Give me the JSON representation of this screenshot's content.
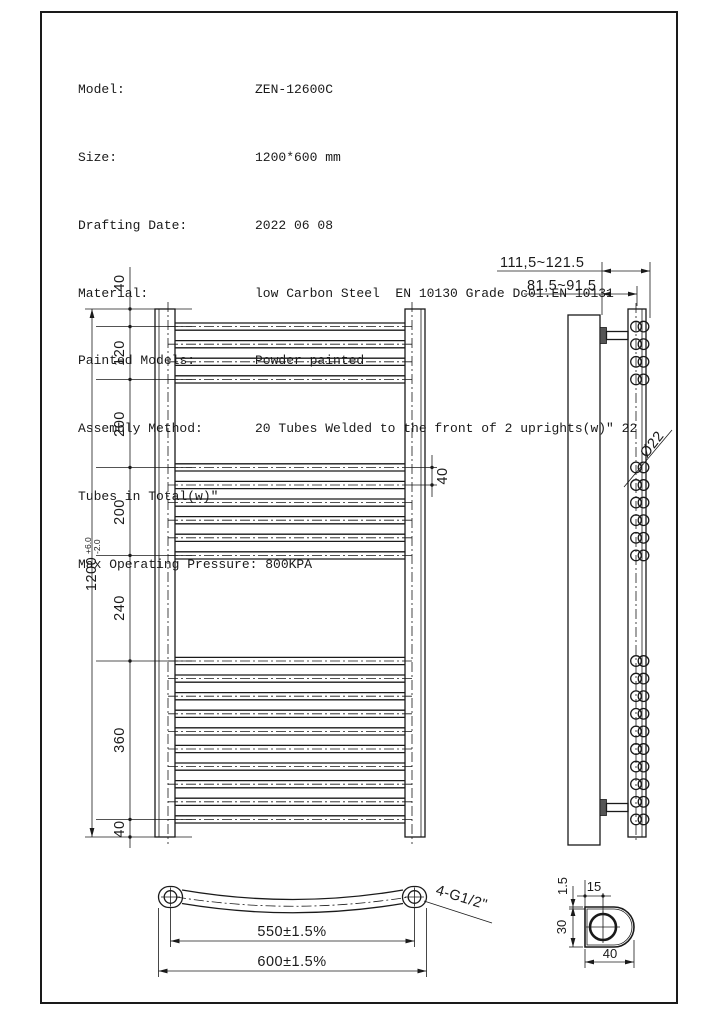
{
  "spec": {
    "rows": [
      {
        "label": "Model:",
        "value": "ZEN-12600C"
      },
      {
        "label": "Size:",
        "value": "1200*600 mm"
      },
      {
        "label": "Drafting Date:",
        "value": "2022 06 08"
      },
      {
        "label": "Material:",
        "value": "low Carbon Steel  EN 10130 Grade Dc01.EN 10131"
      },
      {
        "label": "Painted Models:",
        "value": "Powder painted"
      },
      {
        "label": "Assembly Method:",
        "value": "20 Tubes Welded to the front of 2 uprights(w)\" 22"
      }
    ],
    "assembly_continuation": "Tubes in Total(w)\"",
    "pressure_line": "Max Operating Pressure: 800KPA"
  },
  "front_view": {
    "overall": {
      "value": "1200",
      "tol_plus": "+6.0",
      "tol_minus": "-2.0"
    },
    "chain_labels": [
      "40",
      "120",
      "200",
      "200",
      "240",
      "360",
      "40"
    ],
    "pitch_label": "40",
    "pitch_mm": 40,
    "height_mm": 1200,
    "tube_groups": [
      {
        "start_mm": 40,
        "count": 4
      },
      {
        "start_mm": 360,
        "count": 6
      },
      {
        "start_mm": 800,
        "count": 10
      }
    ]
  },
  "side_view": {
    "dim_wall_to_front": "111,5~121.5",
    "dim_wall_to_upright": "81,5~91.5",
    "tube_diameter": "Ø22"
  },
  "bottom_view": {
    "dim_centres": "550±1.5%",
    "dim_overall": "600±1.5%",
    "fitting": "4-G1/2\""
  },
  "detail_view": {
    "wall_thickness": "1.5",
    "hole_offset": "15",
    "profile_depth": "30",
    "profile_width": "40"
  },
  "colors": {
    "line": "#1a1a1a",
    "background": "#ffffff"
  }
}
